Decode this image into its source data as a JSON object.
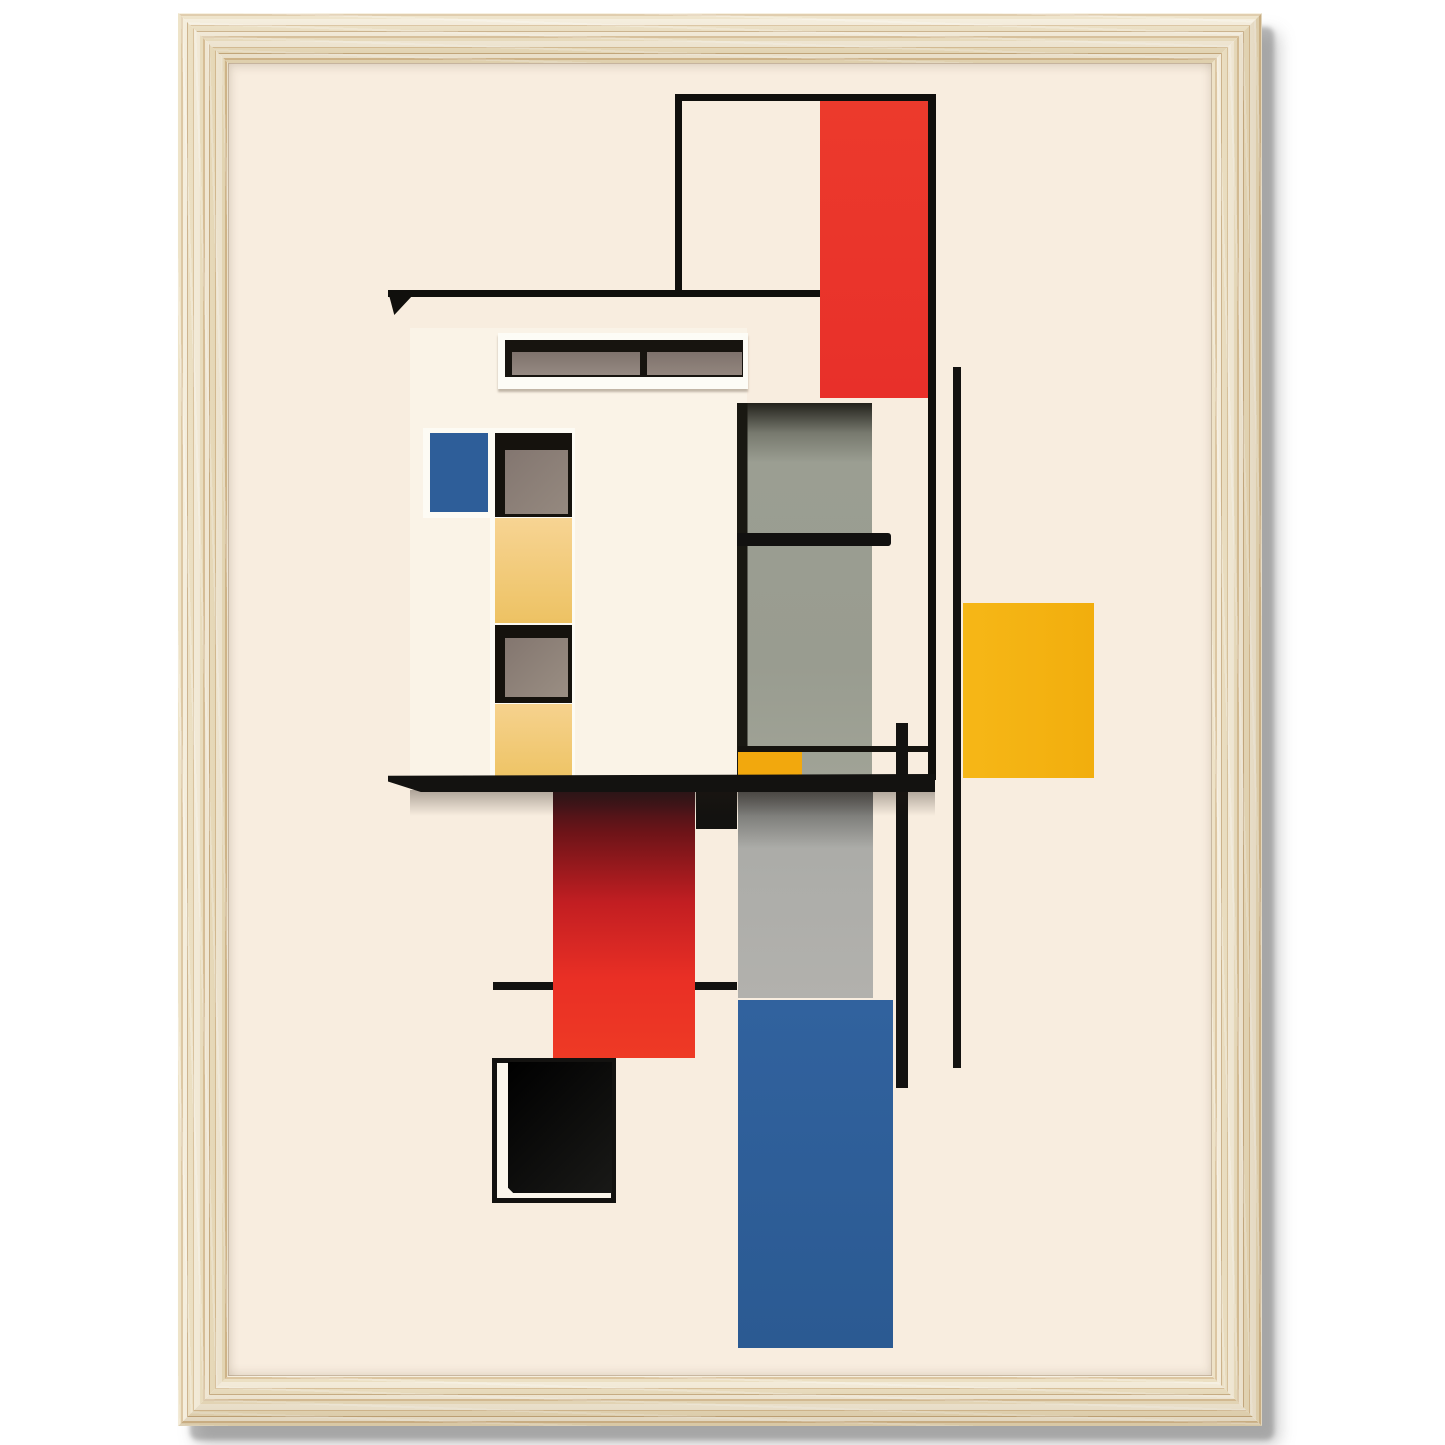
{
  "canvas": {
    "width": 1445,
    "height": 1445,
    "page_background": "#FFFFFF"
  },
  "frame": {
    "x": 178,
    "y": 13,
    "width": 1084,
    "height": 1413,
    "thickness": 50,
    "corner_radius": 8,
    "wood_light": "#F4EBD6",
    "wood_base": "#EADCBA",
    "wood_dark": "#D5BA8E",
    "wood_darker": "#C4A678",
    "mat_color": "#F8EDDF"
  },
  "palette": {
    "black": "#131210",
    "red": "#E93527",
    "red_deep": "#2E1318",
    "blue": "#2E5E99",
    "yellow": "#F5B513",
    "yellow_small": "#F2A80D",
    "yellow_pale": "#F6D392",
    "gray_green": "#9B9E92",
    "gray_light": "#ABACA8",
    "pane_gray": "#857870",
    "white": "#FDFBF4",
    "cream_house": "#FAF3E7"
  },
  "shapes": [
    {
      "name": "poster-background",
      "x": 228,
      "y": 63,
      "w": 984,
      "h": 1313,
      "fill": "#F8EDDF"
    },
    {
      "name": "house-body",
      "x": 410,
      "y": 328,
      "w": 337,
      "h": 449,
      "fill": "#FAF3E7"
    },
    {
      "name": "clerestory-window-frame",
      "x": 498,
      "y": 333,
      "w": 250,
      "h": 56,
      "fill": "#FDFCF6",
      "shadow": "0 3px 2px rgba(90,70,50,0.35)"
    },
    {
      "name": "clerestory-window-glass",
      "x": 505,
      "y": 340,
      "w": 238,
      "h": 37,
      "fill": "#17140F"
    },
    {
      "name": "clerestory-pane-left",
      "x": 512,
      "y": 352,
      "w": 128,
      "h": 23,
      "fill": "linear-gradient(180deg,#7E726C,#968A82)"
    },
    {
      "name": "clerestory-pane-right",
      "x": 647,
      "y": 352,
      "w": 95,
      "h": 23,
      "fill": "linear-gradient(180deg,#7E726C,#93867E)"
    },
    {
      "name": "blue-window-surround",
      "x": 423,
      "y": 428,
      "w": 74,
      "h": 90,
      "fill": "#FDFBF4"
    },
    {
      "name": "blue-window",
      "x": 430,
      "y": 433,
      "w": 58,
      "h": 79,
      "fill": "#2E5E99"
    },
    {
      "name": "window-column",
      "x": 490,
      "y": 428,
      "w": 85,
      "h": 349,
      "fill": "#FDFBF4"
    },
    {
      "name": "column-window-1",
      "x": 495,
      "y": 433,
      "w": 77,
      "h": 84,
      "fill": "#15120D"
    },
    {
      "name": "column-pane-1",
      "x": 505,
      "y": 450,
      "w": 63,
      "h": 64,
      "fill": "linear-gradient(135deg,#837670,#95897F)"
    },
    {
      "name": "column-yellow-1",
      "x": 495,
      "y": 518,
      "w": 77,
      "h": 105,
      "fill": "linear-gradient(180deg,#F7D493,#EDC263)"
    },
    {
      "name": "column-window-2",
      "x": 495,
      "y": 625,
      "w": 77,
      "h": 78,
      "fill": "#15120D"
    },
    {
      "name": "column-pane-2",
      "x": 505,
      "y": 638,
      "w": 63,
      "h": 59,
      "fill": "linear-gradient(135deg,#83766F,#9A8E83)"
    },
    {
      "name": "column-yellow-2",
      "x": 495,
      "y": 704,
      "w": 77,
      "h": 72,
      "fill": "linear-gradient(180deg,#F6D28E,#EEC466)"
    },
    {
      "name": "gray-panel-upper",
      "x": 737,
      "y": 403,
      "w": 135,
      "h": 373,
      "fill": "linear-gradient(90deg,#191812 0px,#191812 10px,rgba(25,24,18,0) 11px),linear-gradient(180deg,#23221C 0%,#77796E 8%,#9B9E92 16%,#999C90 70%,#A0A396 100%)"
    },
    {
      "name": "gray-panel-bar",
      "x": 737,
      "y": 533,
      "w": 154,
      "h": 13,
      "fill": "#121110",
      "radius": "0 3px 3px 0"
    },
    {
      "name": "panel-thin-line",
      "x": 738,
      "y": 746,
      "w": 192,
      "h": 6,
      "fill": "#15130E"
    },
    {
      "name": "small-yellow-rect",
      "x": 738,
      "y": 752,
      "w": 64,
      "h": 23,
      "fill": "#F2A80D"
    },
    {
      "name": "top-horizontal-line",
      "x": 388,
      "y": 290,
      "w": 434,
      "h": 7,
      "fill": "#100F0C"
    },
    {
      "name": "top-line-wedge",
      "x": 389,
      "y": 295,
      "w": 24,
      "h": 20,
      "fill": "#100F0C",
      "clip": "polygon(0 0, 100% 0, 22% 100%)"
    },
    {
      "name": "outline-box-top",
      "x": 675,
      "y": 94,
      "w": 260,
      "h": 7,
      "fill": "#100F0C"
    },
    {
      "name": "outline-box-left",
      "x": 675,
      "y": 94,
      "w": 7,
      "h": 201,
      "fill": "#100F0C"
    },
    {
      "name": "outline-box-right",
      "x": 928,
      "y": 94,
      "w": 8,
      "h": 686,
      "fill": "#100F0C"
    },
    {
      "name": "red-rect-top",
      "x": 820,
      "y": 101,
      "w": 108,
      "h": 297,
      "fill": "linear-gradient(180deg,#EC3A2C,#E8302A)"
    },
    {
      "name": "vertical-line-long",
      "x": 953,
      "y": 367,
      "w": 8,
      "h": 701,
      "fill": "#131210"
    },
    {
      "name": "vertical-line-short",
      "x": 896,
      "y": 723,
      "w": 12,
      "h": 365,
      "fill": "#131210"
    },
    {
      "name": "yellow-square",
      "x": 963,
      "y": 603,
      "w": 131,
      "h": 175,
      "fill": "linear-gradient(90deg,#F6B717,#F2AE0D)"
    },
    {
      "name": "thin-line-mid",
      "x": 493,
      "y": 982,
      "w": 244,
      "h": 8,
      "fill": "#131210"
    },
    {
      "name": "gray-panel-lower",
      "x": 738,
      "y": 790,
      "w": 135,
      "h": 208,
      "fill": "linear-gradient(180deg,rgba(15,13,11,0.50) 0%,rgba(15,13,11,0) 28%),linear-gradient(180deg,#A9AAA6,#B2B1AD)"
    },
    {
      "name": "blue-rect",
      "x": 738,
      "y": 1000,
      "w": 155,
      "h": 348,
      "fill": "linear-gradient(180deg,#31629E,#2B5A92)"
    },
    {
      "name": "red-rect-bottom",
      "x": 553,
      "y": 790,
      "w": 142,
      "h": 268,
      "fill": "linear-gradient(180deg,#2E1318 0%,#6E1418 16%,#C21E22 42%,#E92F25 70%,#EE3A25 100%)"
    },
    {
      "name": "small-black-rect",
      "x": 696,
      "y": 789,
      "w": 41,
      "h": 40,
      "fill": "#131210"
    },
    {
      "name": "bar-shadow",
      "x": 410,
      "y": 790,
      "w": 525,
      "h": 26,
      "fill": "linear-gradient(180deg,rgba(35,26,20,0.35),rgba(35,26,20,0))"
    },
    {
      "name": "main-bar",
      "x": 388,
      "y": 774,
      "w": 547,
      "h": 18,
      "fill": "#131210",
      "clip": "polygon(0 10%, 100% 0, 100% 100%, 6% 100%, 0 42%)"
    },
    {
      "name": "black-box-outline",
      "x": 492,
      "y": 1058,
      "w": 124,
      "h": 145,
      "fill": "#FBF6EC",
      "border": "5px solid #131210"
    },
    {
      "name": "black-box-fill",
      "x": 508,
      "y": 1062,
      "w": 104,
      "h": 131,
      "fill": "linear-gradient(135deg,#000000,#191917)",
      "clip": "polygon(0 0, 100% 0, 100% 100%, 5% 100%, 0 96%)"
    }
  ]
}
